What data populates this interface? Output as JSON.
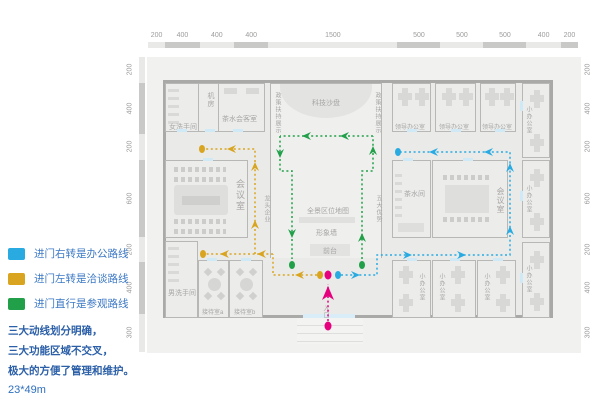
{
  "legend": {
    "items": [
      {
        "key": "office-route",
        "color": "#29abe2",
        "label": "进门右转是办公路线"
      },
      {
        "key": "talk-route",
        "color": "#d9a521",
        "label": "进门左转是洽谈路线"
      },
      {
        "key": "visit-route",
        "color": "#21a049",
        "label": "进门直行是参观路线"
      }
    ],
    "summary": [
      "三大动线划分明确，",
      "三大功能区域不交叉，",
      "极大的方便了管理和维护。"
    ],
    "size_note": "23*49m"
  },
  "dimensions": {
    "top": [
      200,
      400,
      400,
      400,
      1500,
      500,
      500,
      500,
      400,
      200
    ],
    "left": [
      200,
      400,
      200,
      600,
      200,
      400,
      300
    ],
    "right": [
      200,
      400,
      200,
      600,
      200,
      400,
      300
    ]
  },
  "rooms": {
    "women_wc": "女洗手间",
    "machine": "机房",
    "tea_guest": "茶水会客室",
    "sand_table": "科技沙盘",
    "policy": "政策扶持展示",
    "leader_office": "领导办公室",
    "small_office": "小办公室",
    "meeting": "会议室",
    "tea_room": "茶水间",
    "map_wall": "全景区位地图",
    "image_wall": "形象墙",
    "front_desk": "前台",
    "leading_ent": "龙头企业",
    "five_adv": "五大优势",
    "men_wc": "男洗手间",
    "reception_a": "接待室a",
    "reception_b": "接待室b",
    "entrance": "入口"
  },
  "route_colors": {
    "office": "#29abe2",
    "talk": "#d9a521",
    "visit": "#21a049",
    "entry": "#e6007d"
  }
}
